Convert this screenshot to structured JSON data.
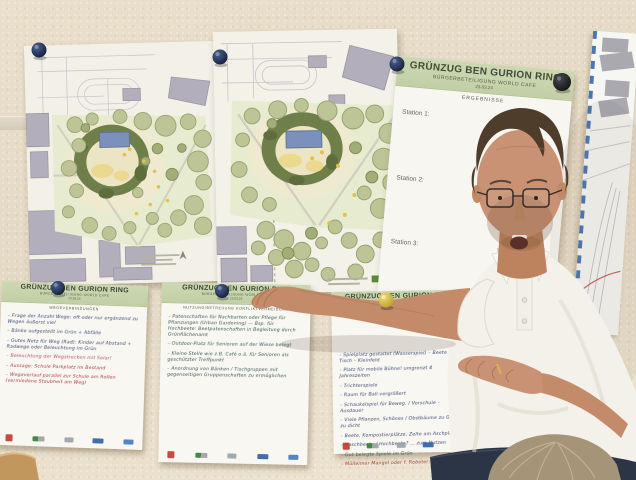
{
  "flipchart": {
    "title": "GRÜNZUG BEN GURION RING",
    "subtitle": "BÜRGERBETEILIGUNG WORLD CAFE",
    "date": "23.03.24",
    "section": "ERGEBNISSE",
    "stations": [
      "Station 1:",
      "Station 2:",
      "Station 3:"
    ]
  },
  "sheets": [
    {
      "title": "GRÜNZUG BEN GURION RING",
      "subtitle": "BÜRGERBETEILIGUNG WORLD CAFE",
      "date": "23.03.24",
      "topic": "WEGEVERBINDUNGEN",
      "notes": [
        "– Frage der Anzahl Wege: oft oder nur ergänzend zu Wegen äußerst viel",
        "– Bänke aufgestellt im Grün + Abfälle",
        "– Gutes Netz für Weg (Rad): Kinder auf Abstand + Radwege oder Beleuchtung im Grün",
        "– Beleuchtung der Wegstrecken mit Solar!",
        "– Aussage: Schule Parkplatz im Bestand",
        "– Wegeverlauf parallel zur Schule am Rollen (vermiedene Staubheit am Weg)"
      ]
    },
    {
      "title": "GRÜNZUG BEN GURION RING",
      "subtitle": "BÜRGERBETEILIGUNG WORLD CAFE",
      "date": "23.03.24",
      "topic": "NUTZUNG/BETREUUNG KONFLIKTVERMEIDUNG",
      "notes": [
        "– Patenschaften für Nachbarten oder Pflege für Pflanzungen (Urban Gardening) — Bsp. für Hochbeete: Beetpatenschaften in Begleitung durch Grünflächenamt",
        "– Outdoor-Platz für Senioren auf der Wiese belegt",
        "– Kleine Stelle wie z.B. Café o.ä. für Senioren als geschützter Treffpunkt",
        "– Anordnung von Bänken / Tischgruppen mit gegenseitigen Gruppenschaften zu ermöglichen"
      ]
    },
    {
      "title": "GRÜNZUG BEN GURION RING",
      "notes": [
        "– Spielplatz gestaltet (Wasserspiel) – Beete – Tisch – Kleinfeld",
        "– Platz für mobile Bühne! umgrenzt 4 Jahreszeiten",
        "– Trichterspiele",
        "– Raum für Ball vergrößert",
        "– Schaukelspiel für Beweg. / Vorschule – Ausdauer",
        "– Viele Pflanzen, Schönes / Obstbäume zu Grün zu dicht",
        "– Beete, Kompostierplätze, Zelte am Aschplatz",
        "– Naschbeete / Hochbeete? … zum Nutzen",
        "– Gut belegte Spiele im Grün",
        "– Mülleimer Mangel oder f. Roboter: Abfall"
      ]
    }
  ],
  "colors": {
    "header_green": "#c8d5ae",
    "pin_navy": "#2b3a5f",
    "pin_black": "#1d1d20",
    "pin_yellow": "#e3c84b",
    "ink_blue": "#33406e",
    "ink_red": "#a83434"
  }
}
